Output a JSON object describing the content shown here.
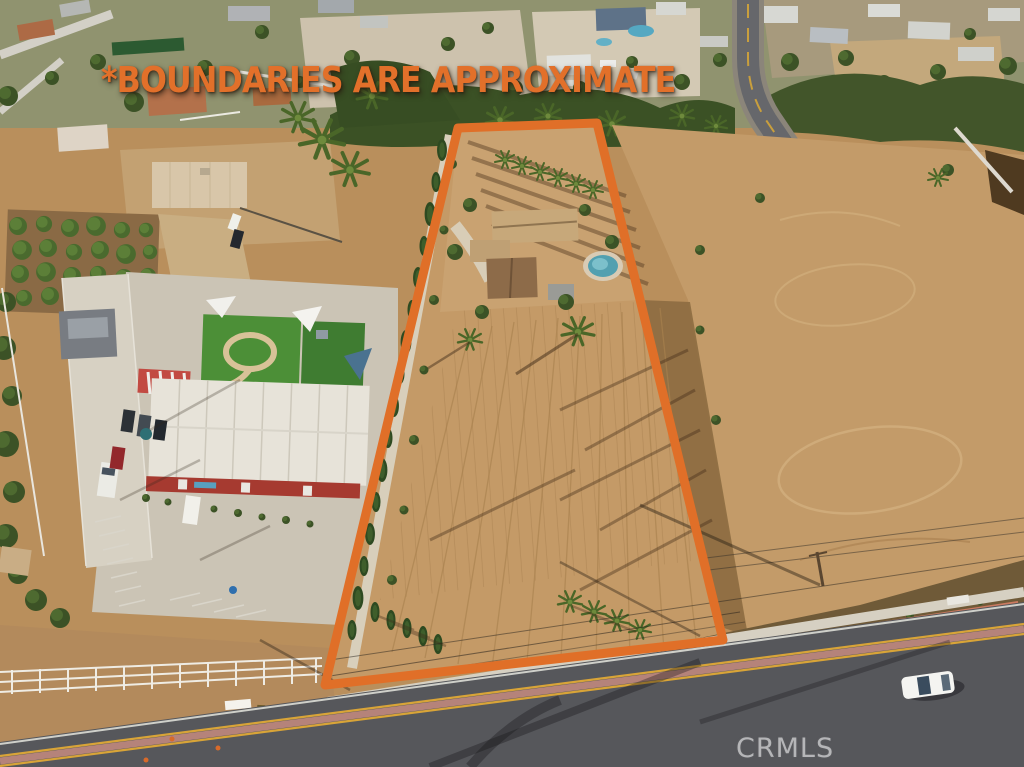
{
  "overlay": {
    "disclaimer_text": "*BOUNDARIES ARE APPROXIMATE",
    "watermark_text": "CRMLS"
  },
  "colors": {
    "boundary_orange": "#E06F28",
    "disclaimer_orange": "#E2702A",
    "watermark_gray": "#EBEBEE"
  },
  "scene": {
    "type": "aerial-drone-photo",
    "subject": "vacant graded lot with single-story house and pool outlined in orange boundary lines"
  }
}
